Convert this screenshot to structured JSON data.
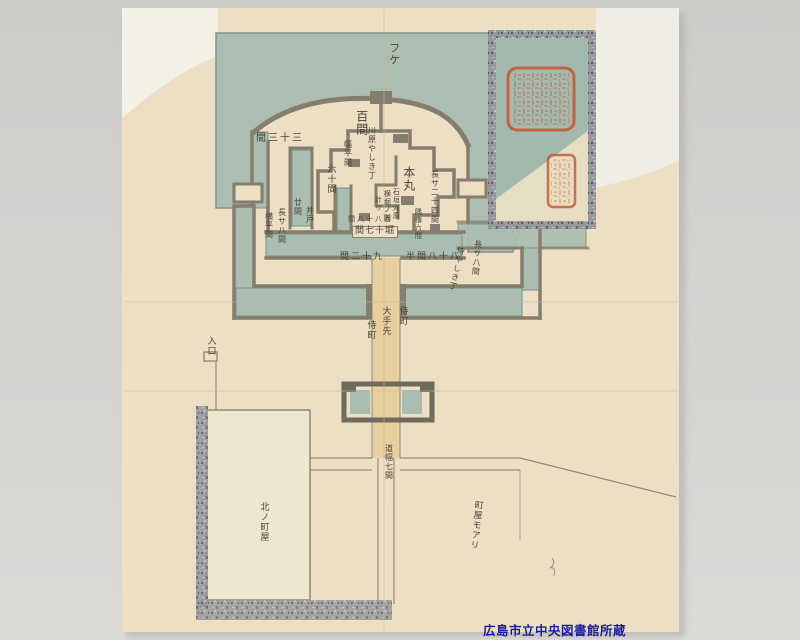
{
  "caption": {
    "text": "広島市立中央図書館所蔵",
    "color": "#1b1b99"
  },
  "map": {
    "labels": {
      "fuke": "フケ",
      "moat_33": "間三十三",
      "hyakken": "百間",
      "haba_note": "幅平間",
      "kawara_note": "川原やしき丁",
      "rokujukken": "六十間",
      "nijukken": "廿間",
      "ido": "井戸",
      "nagasa8_west": "長サ八間",
      "yokohira": "横平間",
      "honmaru": "本丸",
      "honmaru_note1": "石垣河原",
      "honmaru_note2": "横堀ノ間",
      "honmaru_note3": "計リ",
      "east_note": "長サ二十四間",
      "sumi_note": "隅櫓六間",
      "hyaku88": "間八十八百",
      "hori17": "間七十堀",
      "ken29": "間二十九",
      "ken88_half": "半間八十八",
      "samurai_yashiki": "侍やしき丁",
      "nagasa8_east": "長サ八間",
      "otesaki": "大手先",
      "samurai_machi_left": "侍町",
      "samurai_machi_right": "侍町",
      "iriguchi": "入口",
      "michihaba": "道幅七間",
      "kita_machiya": "北ノ町屋",
      "machiya_ari": "町屋モアリ"
    }
  },
  "colors": {
    "backdrop": "#d3d1ce",
    "paper": "#f5f2e9",
    "map_cream": "#ecdfc4",
    "water_green": "#a9bdb1",
    "wall_gray": "#857d6d",
    "road_tan": "#e7cfa0",
    "seal_red": "#c3552f",
    "caption_blue": "#1b1b99",
    "ink": "#4a4137"
  }
}
